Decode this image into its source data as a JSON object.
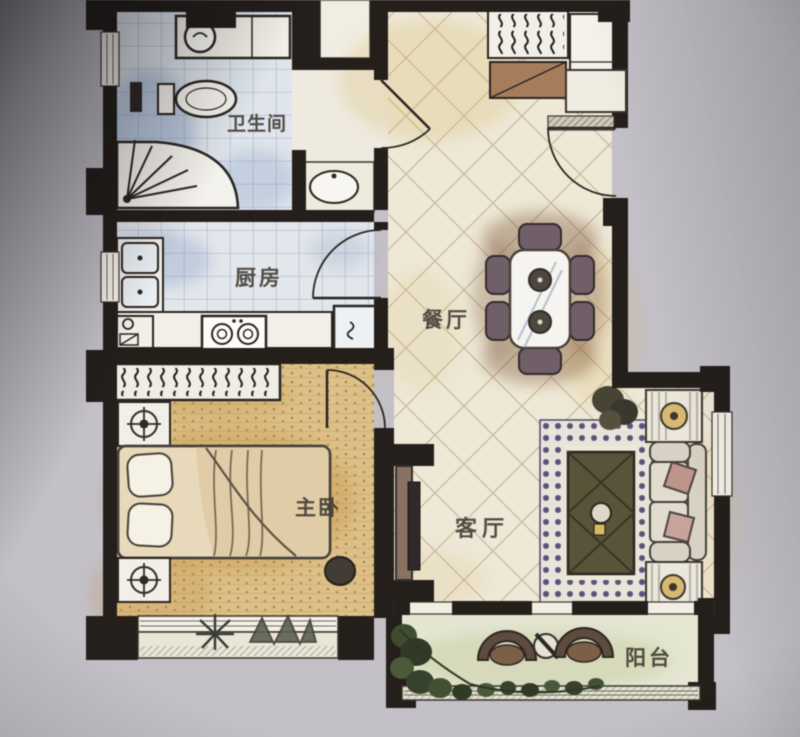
{
  "photo": {
    "description": "photograph of a hand-rendered apartment floor plan",
    "background_color": "#c3c0c7",
    "paper_color": "#efe9da"
  },
  "rooms": {
    "bathroom": {
      "label": "卫生间"
    },
    "kitchen": {
      "label": "厨房"
    },
    "dining": {
      "label": "餐厅"
    },
    "bedroom": {
      "label": "主卧"
    },
    "living": {
      "label": "客厅"
    },
    "balcony": {
      "label": "阳台"
    }
  },
  "furniture_visible": {
    "bathroom": [
      "washing-machine",
      "toilet",
      "corner-shower",
      "washbasin"
    ],
    "kitchen": [
      "double-sink",
      "base-cabinet",
      "counter",
      "two-burner-stove",
      "refrigerator"
    ],
    "entry": [
      "coat-closet-with-hangers",
      "shoe-cabinet",
      "tall-cabinet",
      "entry-door",
      "threshold-mat"
    ],
    "dining": [
      "dining-table",
      "six-chairs"
    ],
    "bedroom": [
      "wardrobe-with-hangers",
      "double-bed",
      "pillows",
      "two-nightstands",
      "two-lamps",
      "foot-stool",
      "bay-window-plants"
    ],
    "living": [
      "tv-cabinet",
      "tv",
      "area-rug",
      "coffee-table",
      "sofa",
      "throw-pillows",
      "two-side-tables",
      "plant"
    ],
    "balcony": [
      "two-round-chairs",
      "round-table",
      "planter-greenery"
    ]
  },
  "palette": {
    "wall": "#241f1b",
    "tile_blue": "#dfe5ec",
    "tile_line_blue": "#7d90b4",
    "diag_tile_cream": "#efe8d6",
    "wood_floor_tan": "#dfc083",
    "blush_orange": "#c98a2e",
    "rug_violet": "#5f567e",
    "plant_green": "#3c4a2e",
    "chair_mauve": "#715f6a"
  }
}
